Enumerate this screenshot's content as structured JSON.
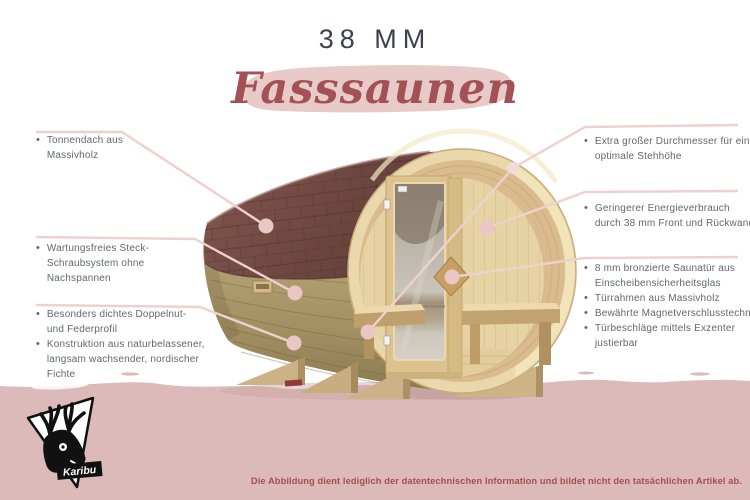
{
  "bullet": "•",
  "header": {
    "thickness": "38 MM",
    "product": "Fasssaunen"
  },
  "callouts": {
    "left": [
      {
        "lines": [
          "Tonnendach aus",
          "Massivholz"
        ]
      },
      {
        "lines": [
          "Wartungsfreies Steck-",
          "Schraubsystem ohne",
          "Nachspannen"
        ]
      },
      {
        "lines": [
          "Besonders dichtes Doppelnut-",
          "und Federprofil"
        ]
      },
      {
        "lines": [
          "Konstruktion aus naturbelassener,",
          "langsam wachsender, nordischer",
          "Fichte"
        ]
      }
    ],
    "right": [
      {
        "lines": [
          "Extra großer Durchmesser für eine",
          "optimale Stehhöhe"
        ]
      },
      {
        "lines": [
          "Geringerer Energieverbrauch",
          "durch 38 mm Front und Rückwand"
        ]
      },
      {
        "lines": [
          "8 mm bronzierte Saunatür aus",
          "Einscheibensicherheitsglas"
        ]
      },
      {
        "lines": [
          "Türrahmen aus Massivholz"
        ]
      },
      {
        "lines": [
          "Bewährte Magnetverschlusstechnik"
        ]
      },
      {
        "lines": [
          "Türbeschläge mittels Exzenter",
          "justierbar"
        ]
      }
    ]
  },
  "footer": {
    "disclaimer": "Die Abbildung dient lediglich der datentechnischen Information und bildet nicht den tatsächlichen Artikel ab."
  },
  "logo": {
    "brand": "Karibu"
  },
  "colors": {
    "ground_pink": "#dcbab9",
    "brush_pink": "#e8cbc8",
    "title_dark": "#3d4150",
    "script_red": "#a35156",
    "label_gray": "#63666a",
    "callout_line": "#eed0cd",
    "callout_dot": "#eac7c4",
    "roof_brown": "#6c453f",
    "stave_wood": "#a8966a",
    "front_wood": "#ead7ab"
  }
}
